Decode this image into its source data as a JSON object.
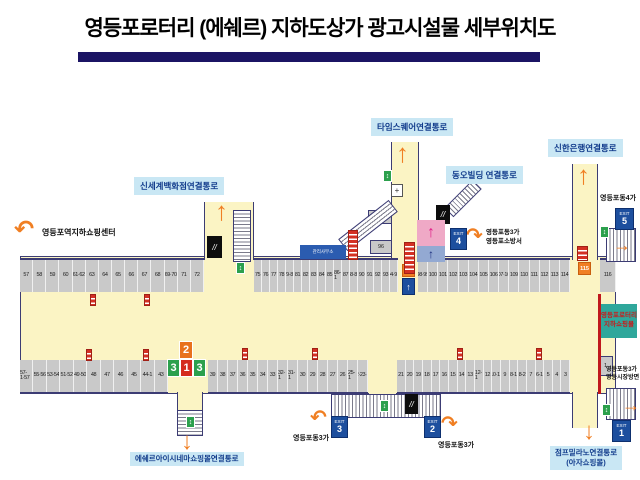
{
  "title": {
    "text": "영등포로터리 (에쉐르) 지하도상가 광고시설물 세부위치도"
  },
  "passages": {
    "shinsegae": "신세계백화점연결통로",
    "timessquare": "타임스퀘어연결통로",
    "dongo": "동오빌딩 연결통로",
    "shinhan": "신한은행연결통로",
    "escher": "에쉐르아이시네마쇼핑몰연결통로",
    "jump_milano_line1": "점프밀라노연결통로",
    "jump_milano_line2": "(아자쇼핑몰)",
    "station": "영등포역지하쇼핑센터"
  },
  "area_labels": {
    "exit4_line1": "영등포동3가",
    "exit4_line2": "영등포소방서",
    "exit5_area": "영등포동4가",
    "exit3_area": "영등포동3가",
    "exit2_area": "영등포동3가",
    "exit1_line1": "영등포동3가",
    "exit1_line2": "영등시장방면",
    "mall_box_line1": "영등포로터리",
    "mall_box_line2": "지하쇼핑몰",
    "office_box": "관리사무소"
  },
  "exits": {
    "exit1": {
      "word": "EXIT",
      "num": "1"
    },
    "exit2": {
      "word": "EXIT",
      "num": "2"
    },
    "exit3": {
      "word": "EXIT",
      "num": "3"
    },
    "exit4": {
      "word": "EXIT",
      "num": "4"
    },
    "exit5": {
      "word": "EXIT",
      "num": "5"
    }
  },
  "cells": {
    "top_left": [
      "57",
      "58",
      "59",
      "60",
      "61·62",
      "63",
      "64",
      "65",
      "66",
      "67",
      "68",
      "69·70",
      "71",
      "72"
    ],
    "top_mid": [
      "75",
      "76",
      "77",
      "78",
      "79·80",
      "81",
      "82",
      "83",
      "84",
      "85",
      "86-1",
      "87",
      "88·89",
      "90",
      "91",
      "92",
      "93",
      "94·95"
    ],
    "top_right": [
      "98·99",
      "100",
      "101",
      "102",
      "103",
      "104",
      "105",
      "106",
      "107·108",
      "109",
      "110",
      "111",
      "112",
      "113",
      "114"
    ],
    "cell_116": "116",
    "cell_97_1": "97-1",
    "cell_96": "96",
    "cell_97": "97",
    "cell_115": "115",
    "bottom_left": [
      "57-1·57",
      "55·56",
      "53·54",
      "51·52",
      "49·50",
      "48",
      "47",
      "46",
      "45",
      "44-1",
      "43"
    ],
    "bottom_mid": [
      "39",
      "38",
      "37",
      "36",
      "35",
      "34",
      "33",
      "32-1",
      "31-1",
      "30",
      "29",
      "28",
      "27",
      "26",
      "25-1",
      "22·23·24"
    ],
    "bottom_right": [
      "21",
      "20",
      "19",
      "18",
      "17",
      "16",
      "15",
      "14",
      "13",
      "12-1",
      "12",
      "10·11",
      "9",
      "8-1",
      "8-2",
      "7",
      "6-1",
      "5",
      "4",
      "3"
    ],
    "cell_1": "1"
  },
  "markers": {
    "orange_2": "2",
    "green_3a": "3",
    "red_1": "1",
    "green_3b": "3"
  },
  "icons": {
    "arrow_up": "↑",
    "arrow_down": "↓",
    "arrow_right": "→",
    "arrow_turn_left": "↶",
    "arrow_turn_right": "↷",
    "escalator": "//",
    "cross": "+",
    "stair_marker": "↕",
    "pedestrian": "↑"
  },
  "colors": {
    "title_bar_navy": "#1b1464",
    "corridor_yellow": "#fbf4c4",
    "cell_gray": "#c9c9c9",
    "label_blue_bg": "#c9e7f4",
    "label_blue_text": "#123c8c",
    "arrow_orange": "#f07f23",
    "exit_navy": "#1d4f9e",
    "teal_box": "#2fa79b",
    "pink_box": "#efa9c6",
    "bluegray_box": "#93a9d2",
    "green_marker": "#2ca04d",
    "red_marker": "#d42b1e"
  }
}
